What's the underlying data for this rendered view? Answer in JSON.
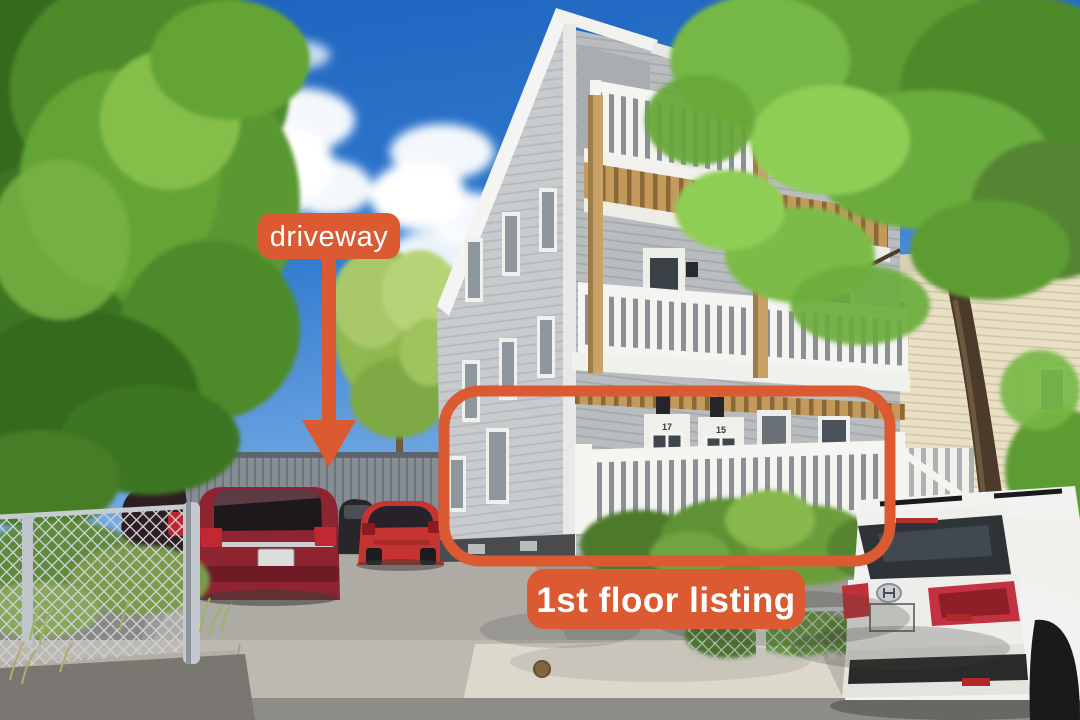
{
  "annotations": {
    "accent_color": "#DB5A31",
    "label_text_color": "#FFFFFF",
    "driveway_label": "driveway",
    "listing_label": "1st floor listing",
    "arrow_icon": "down-arrow",
    "highlight_shape": "rounded-rectangle-outline"
  },
  "scene": {
    "description": "Three-story gray multifamily house with stacked white balconies; annotated driveway with parked cars; white SUV parked on street",
    "house": {
      "left_door_number": "17",
      "right_door_number": "15",
      "siding_color": "#BFC3C6",
      "trim_color": "#F2F2EE",
      "deck_wood_color": "#C49A5C"
    },
    "environment": {
      "sky_color": "#2E76CC",
      "foliage_color": "#5E9C34",
      "asphalt_color": "#9C9A96"
    },
    "vehicles": {
      "driveway": [
        "dark red SUV",
        "red hatchback",
        "dark parked car"
      ],
      "street": [
        "white SUV"
      ]
    }
  }
}
